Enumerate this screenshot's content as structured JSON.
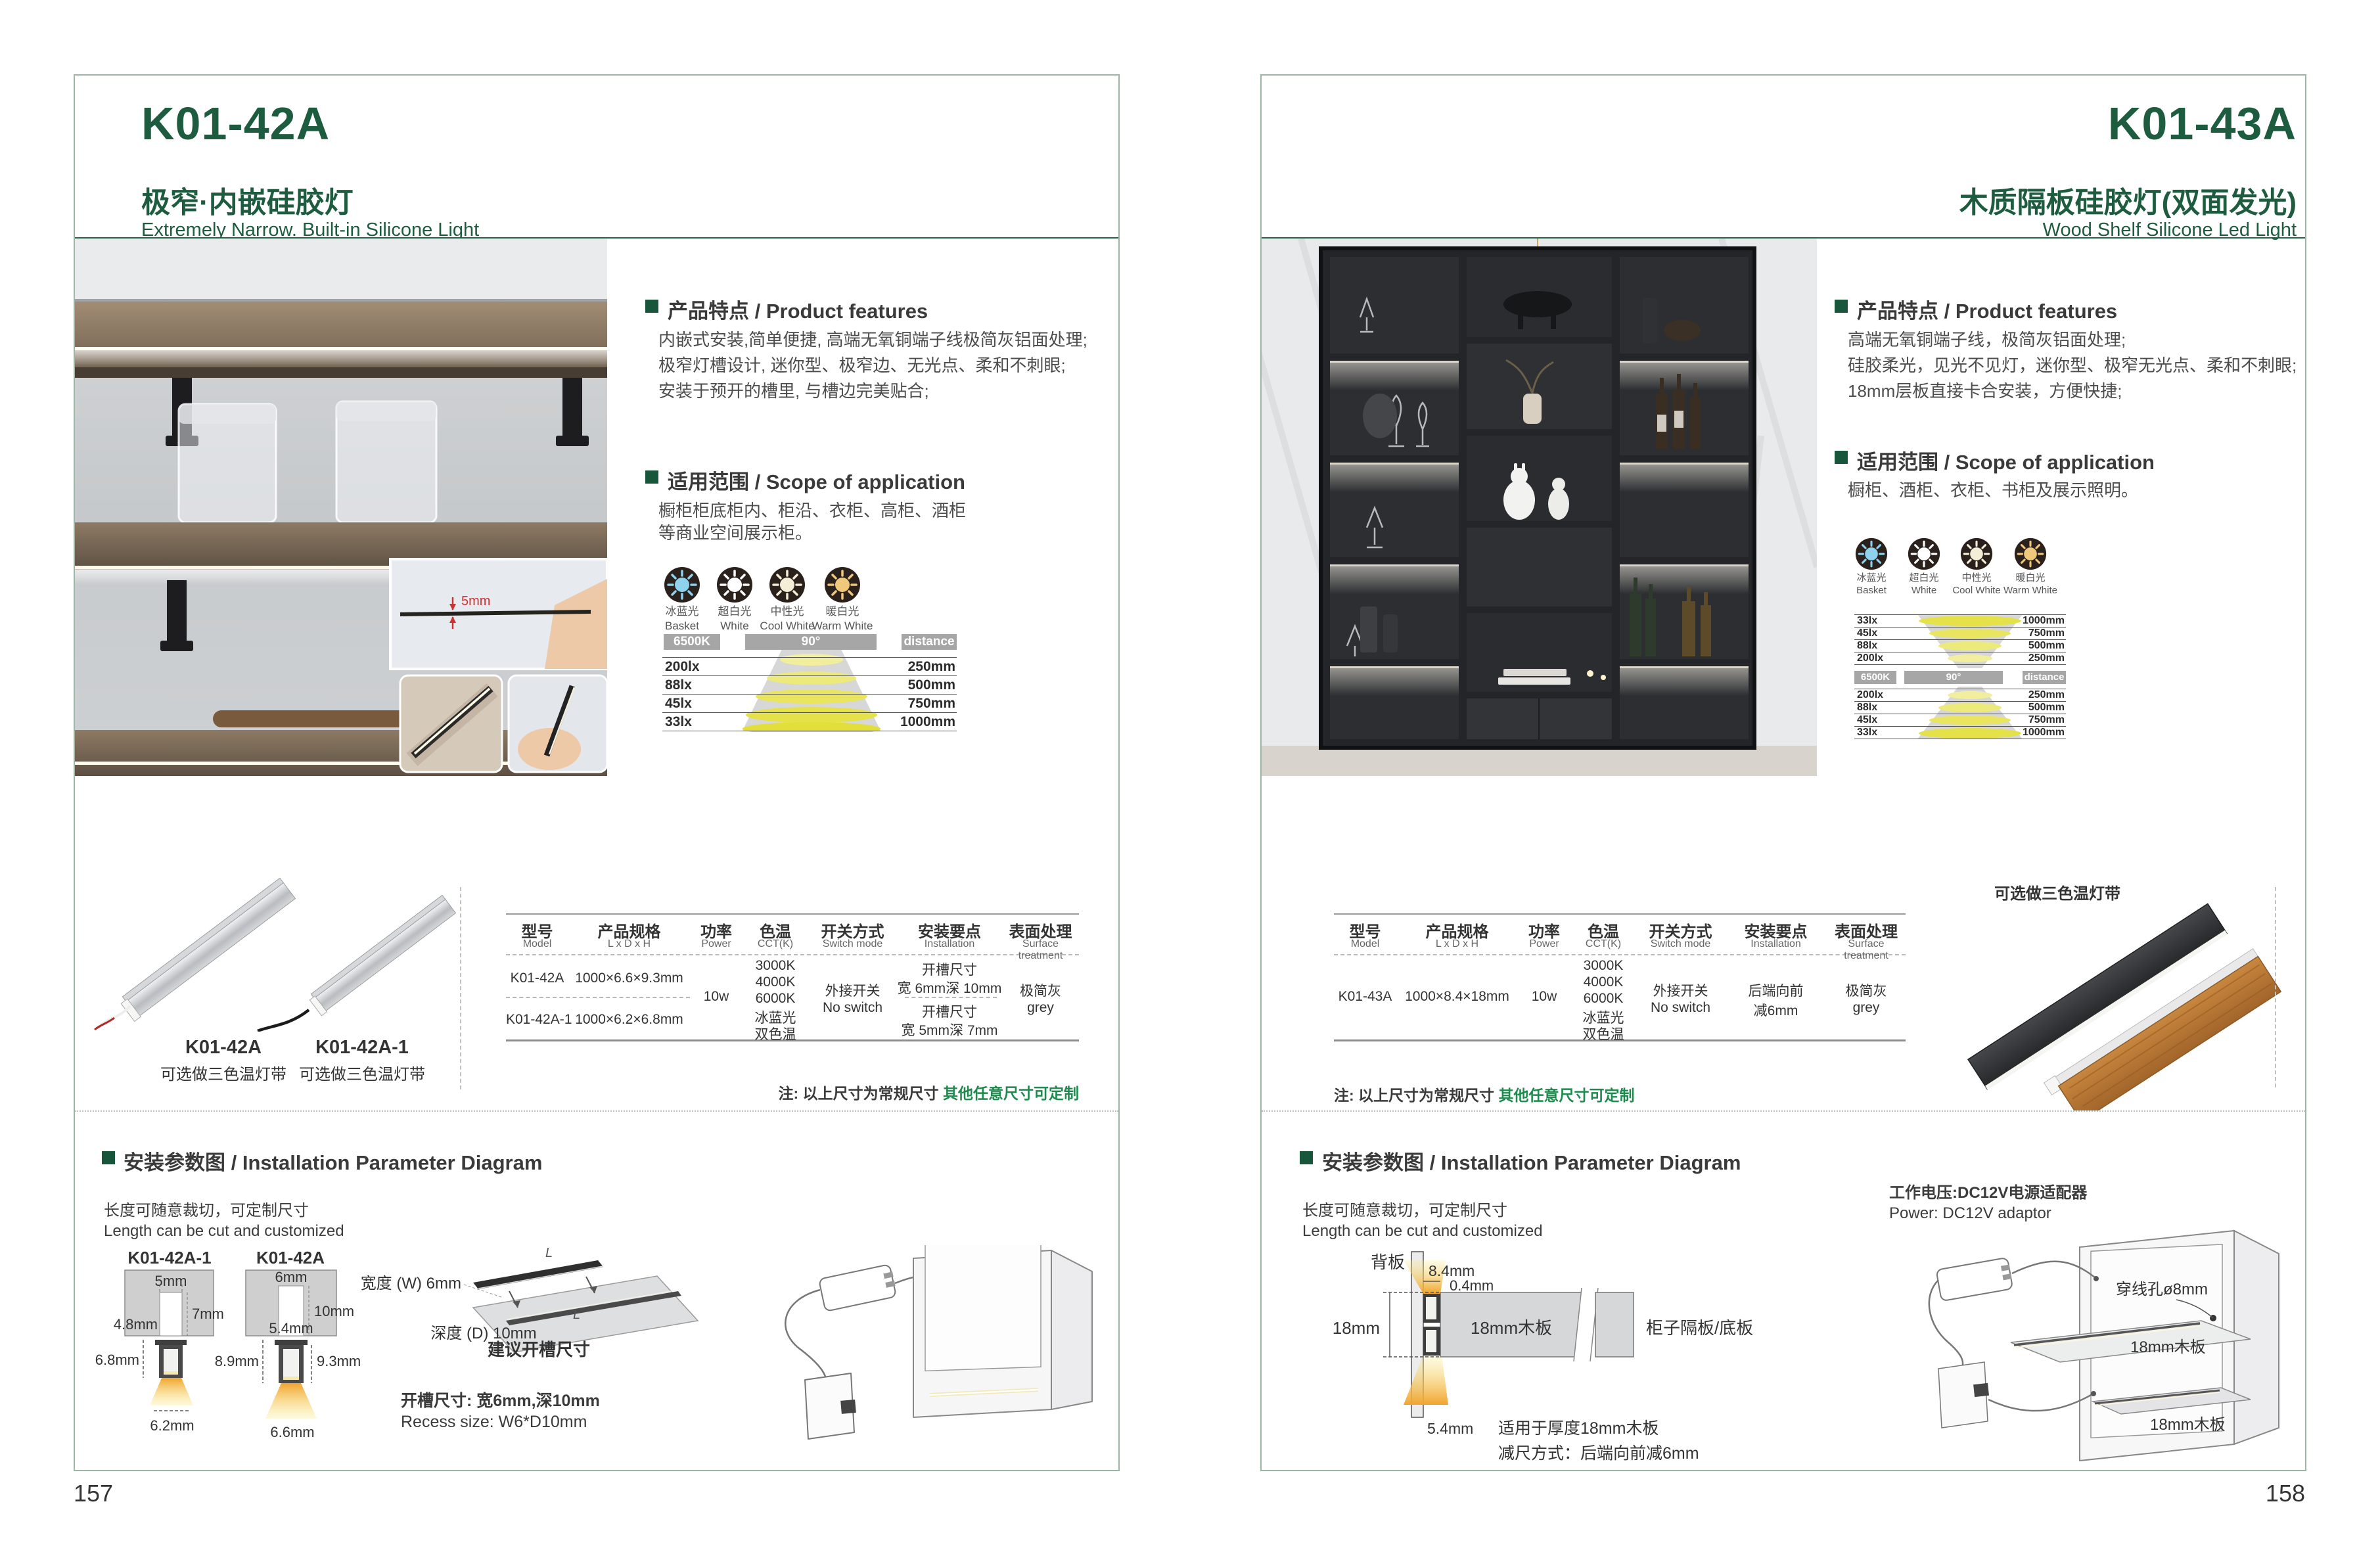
{
  "colors": {
    "brand_green": "#1e5c3f",
    "note_green": "#1f8a4d",
    "bar_gray": "#a6a6a6"
  },
  "shared": {
    "features_heading": "产品特点 / Product features",
    "scope_heading": "适用范围 / Scope of application",
    "install_heading": "安装参数图 / Installation Parameter Diagram",
    "cut_cn": "长度可随意裁切，可定制尺寸",
    "cut_en": "Length can be cut and customized",
    "note_prefix": "注: 以上尺寸为常规尺寸 ",
    "note_highlight": "其他任意尺寸可定制",
    "tri_note": "可选做三色温灯带",
    "icons": [
      {
        "cn": "冰蓝光",
        "en": "Basket",
        "hex": "#8ed2ee"
      },
      {
        "cn": "超白光",
        "en": "White",
        "hex": "#ffffff"
      },
      {
        "cn": "中性光",
        "en": "Cool White",
        "hex": "#f5eed6"
      },
      {
        "cn": "暖白光",
        "en": "Warm White",
        "hex": "#f0c87c"
      }
    ],
    "dist": {
      "cct": "6500K",
      "angle": "90°",
      "d": "distance"
    },
    "lux": [
      [
        "200lx",
        "250mm"
      ],
      [
        "88lx",
        "500mm"
      ],
      [
        "45lx",
        "750mm"
      ],
      [
        "33lx",
        "1000mm"
      ]
    ],
    "lux_rev": [
      [
        "33lx",
        "1000mm"
      ],
      [
        "45lx",
        "750mm"
      ],
      [
        "88lx",
        "500mm"
      ],
      [
        "200lx",
        "250mm"
      ]
    ],
    "spec_headers": [
      {
        "cn": "型号",
        "en": "Model"
      },
      {
        "cn": "产品规格",
        "en": "L x D x H"
      },
      {
        "cn": "功率",
        "en": "Power"
      },
      {
        "cn": "色温",
        "en": "CCT(K)"
      },
      {
        "cn": "开关方式",
        "en": "Switch mode"
      },
      {
        "cn": "安装要点",
        "en": "Installation"
      },
      {
        "cn": "表面处理",
        "en": "Surface treatment"
      }
    ],
    "power": "10w",
    "cct": [
      "3000K",
      "4000K",
      "6000K",
      "冰蓝光",
      "双色温"
    ],
    "switch_cn": "外接开关",
    "switch_en": "No switch",
    "surface_cn": "极简灰",
    "surface_en": "grey"
  },
  "left": {
    "model": "K01-42A",
    "title_cn": "极窄·内嵌硅胶灯",
    "title_en": "Extremely Narrow. Built-in Silicone Light",
    "features": [
      "内嵌式安装,简单便捷, 高端无氧铜端子线极简灰铝面处理;",
      "极窄灯槽设计, 迷你型、极窄边、无光点、柔和不刺眼;",
      "安装于预开的槽里, 与槽边完美贴合;"
    ],
    "scope": [
      "橱柜柜底柜内、柜沿、衣柜、高柜、酒柜",
      "等商业空间展示柜。"
    ],
    "inset_dim": "5mm",
    "products": [
      {
        "model": "K01-42A"
      },
      {
        "model": "K01-42A-1"
      }
    ],
    "rows": [
      {
        "model": "K01-42A",
        "size": "1000×6.6×9.3mm",
        "inst_t": "开槽尺寸",
        "inst_v": "宽 6mm深 10mm"
      },
      {
        "model": "K01-42A-1",
        "size": "1000×6.2×6.8mm",
        "inst_t": "开槽尺寸",
        "inst_v": "宽 5mm深 7mm"
      }
    ],
    "diag": {
      "d1_title": "K01-42A-1",
      "d1_top": "5mm",
      "d1_depth": "7mm",
      "d1_inner": "4.8mm",
      "d1_h": "6.8mm",
      "d1_bottom": "6.2mm",
      "d2_title": "K01-42A",
      "d2_top": "6mm",
      "d2_depth": "10mm",
      "d2_inner": "5.4mm",
      "d2_hl": "8.9mm",
      "d2_hr": "9.3mm",
      "d2_bottom": "6.6mm",
      "slot_w": "宽度 (W) 6mm",
      "slot_d": "深度 (D) 10mm",
      "suggest": "建议开槽尺寸",
      "len": "L",
      "recess_cn": "开槽尺寸: 宽6mm,深10mm",
      "recess_en": "Recess size: W6*D10mm"
    },
    "page_no": "157"
  },
  "right": {
    "model": "K01-43A",
    "title_cn": "木质隔板硅胶灯(双面发光)",
    "title_en": "Wood Shelf Silicone Led Light",
    "features": [
      "高端无氧铜端子线，极简灰铝面处理;",
      "硅胶柔光，见光不见灯，迷你型、极窄无光点、柔和不刺眼;",
      "18mm层板直接卡合安装，方便快捷;"
    ],
    "scope": [
      "橱柜、酒柜、衣柜、书柜及展示照明。"
    ],
    "row": {
      "model": "K01-43A",
      "size": "1000×8.4×18mm",
      "inst_t": "后端向前",
      "inst_v": "减6mm"
    },
    "diag": {
      "back": "背板",
      "dim_a": "8.4mm",
      "dim_b": "0.4mm",
      "dim_c": "18mm",
      "dim_d": "5.4mm",
      "board": "18mm木板",
      "shelf": "柜子隔板/底板",
      "fit1": "适用于厚度18mm木板",
      "fit2": "减尺方式：后端向前减6mm",
      "power_cn": "工作电压:DC12V电源适配器",
      "power_en": "Power: DC12V adaptor",
      "hole": "穿线孔ø8mm",
      "board2": "18mm木板",
      "board3": "18mm木板"
    },
    "page_no": "158"
  }
}
